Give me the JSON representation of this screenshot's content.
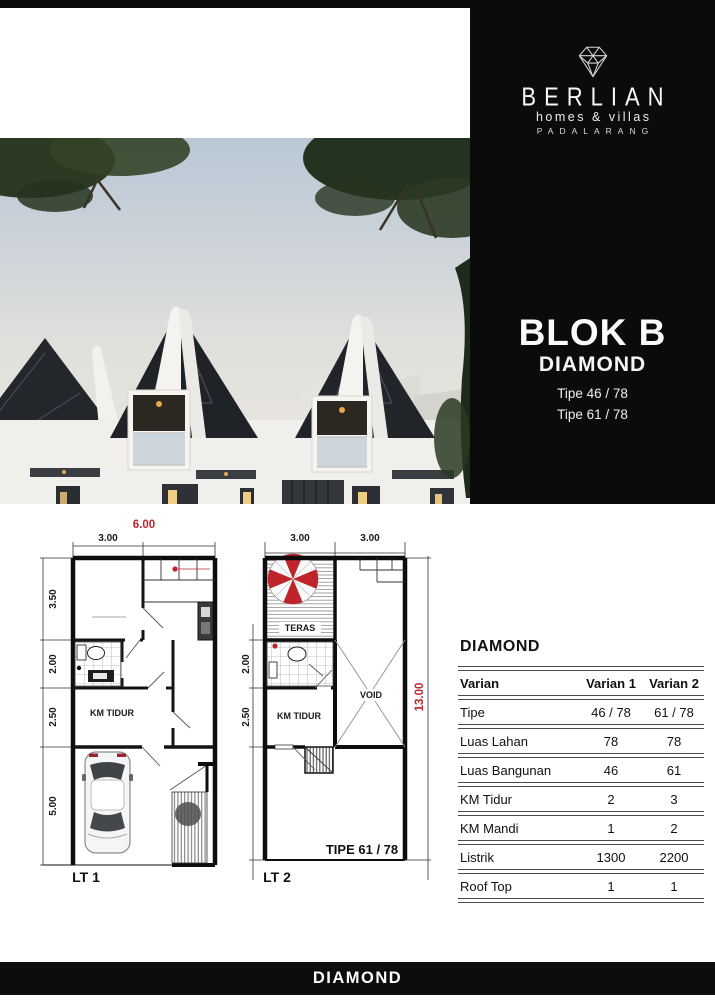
{
  "brand": {
    "logo_icon": "diamond-wireframe-icon",
    "name": "BERLIAN",
    "tagline": "homes & villas",
    "location": "PADALARANG"
  },
  "block": {
    "title": "BLOK B",
    "series": "DIAMOND",
    "types": [
      "Tipe 46 / 78",
      "Tipe 61 / 78"
    ]
  },
  "floorplans": {
    "lt1": {
      "total_width": "6.00",
      "width_left": "3.00",
      "heights": [
        "3.50",
        "2.00",
        "2.50",
        "5.00"
      ],
      "bedroom": "KM TIDUR",
      "floor": "LT 1"
    },
    "lt2": {
      "widths": [
        "3.00",
        "3.00"
      ],
      "teras": "TERAS",
      "heights": [
        "2.00",
        "2.50"
      ],
      "bedroom": "KM TIDUR",
      "void": "VOID",
      "total_height": "13.00",
      "type": "TIPE 61 / 78",
      "floor": "LT 2"
    }
  },
  "spec_table": {
    "title": "DIAMOND",
    "headers": [
      "Varian",
      "Varian 1",
      "Varian 2"
    ],
    "rows": [
      [
        "Tipe",
        "46 / 78",
        "61 / 78"
      ],
      [
        "Luas Lahan",
        "78",
        "78"
      ],
      [
        "Luas Bangunan",
        "46",
        "61"
      ],
      [
        "KM Tidur",
        "2",
        "3"
      ],
      [
        "KM Mandi",
        "1",
        "2"
      ],
      [
        "Listrik",
        "1300",
        "2200"
      ],
      [
        "Roof Top",
        "1",
        "1"
      ]
    ]
  },
  "footer": {
    "label": "DIAMOND"
  },
  "colors": {
    "accent_red": "#c0242b",
    "panel_black": "#0b0b0b"
  }
}
